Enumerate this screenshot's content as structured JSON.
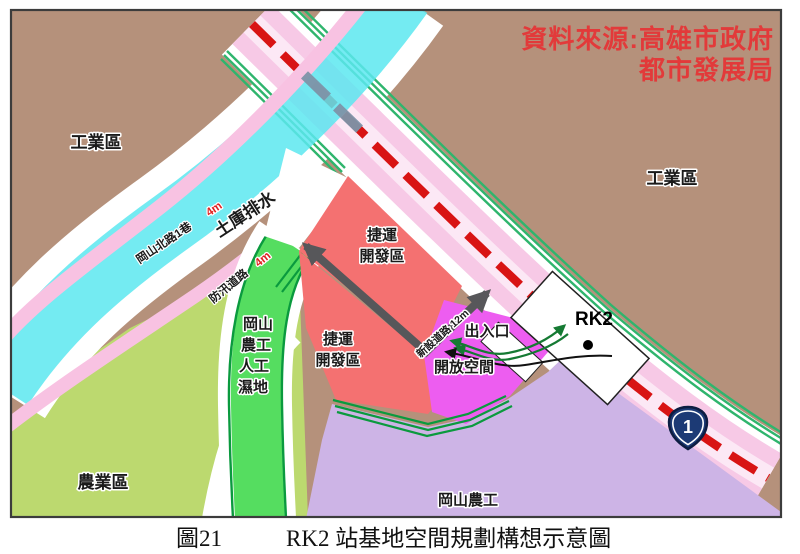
{
  "map": {
    "credit": {
      "line1": "資料來源:高雄市政府",
      "line2": "都市發展局"
    },
    "regions": {
      "industrial_left": "工業區",
      "industrial_right": "工業區",
      "agricultural": "農業區",
      "school": "岡山農工",
      "wetland_lines": [
        "岡山",
        "農工",
        "人工",
        "濕地"
      ],
      "mrt_dev": {
        "line1": "捷運",
        "line2": "開發區"
      },
      "open_space": "開放空間",
      "entrance": "出入口"
    },
    "roads": {
      "gangshan_lane": "岡山北路1巷",
      "gangshan_lane_width": "4m",
      "flood_road": "防汛道路",
      "flood_road_width": "4m",
      "drainage": "土庫排水",
      "new_road": "新設道路 12m"
    },
    "station": {
      "label": "RK2"
    },
    "highway": {
      "number": "1"
    },
    "colors": {
      "industrial": "#b5917b",
      "agricultural": "#bcd96f",
      "school_area": "#cdb4e6",
      "wetland": "#55dd60",
      "drainage": "#5ce8f0",
      "road_pink": "#f7c9e6",
      "bank_road_pink": "#f8c2e2",
      "mrt_zone": "#f47171",
      "open_space": "#ed5df0",
      "mrt_line_red": "#d81414",
      "credit_red": "#e23a3a",
      "highway_blue": "#1c3a75"
    }
  },
  "caption": {
    "number": "圖21",
    "title": "RK2 站基地空間規劃構想示意圖"
  }
}
